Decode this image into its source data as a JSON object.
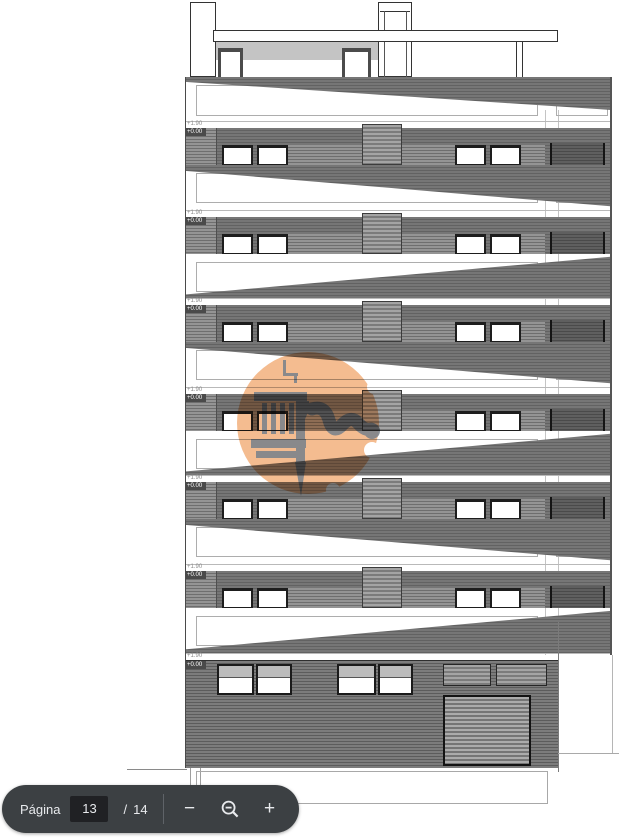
{
  "viewer": {
    "toolbar": {
      "page_label": "Página",
      "current_page": "13",
      "separator": "/",
      "total_pages": "14",
      "zoom_out_icon": "minus-icon",
      "zoom_reset_icon": "magnifier-minus-icon",
      "zoom_in_icon": "plus-icon",
      "background": "#3c4043",
      "input_background": "#202124",
      "text_color": "#e8eaed"
    }
  },
  "drawing": {
    "type": "architectural-building-elevation",
    "floors": [
      {
        "level_label": "+1.90",
        "base_label": "+0.00"
      },
      {
        "level_label": "+1.90",
        "base_label": "+0.00"
      },
      {
        "level_label": "+1.90",
        "base_label": "+0.00"
      },
      {
        "level_label": "+1.90",
        "base_label": "+0.00"
      },
      {
        "level_label": "+1.90",
        "base_label": "+0.00"
      },
      {
        "level_label": "+1.90",
        "base_label": "+0.00"
      },
      {
        "level_label": "+1.90",
        "base_label": "+0.00"
      }
    ],
    "colors": {
      "facade_dark": "#6e6e6e",
      "facade_light": "#919191",
      "parapet_gray": "#c4c4c4",
      "frame_black": "#1d1d1d",
      "guide_line": "#adadad"
    },
    "watermark": {
      "shape": "circle-logo",
      "icon": "caliper-logo-icon",
      "circle_color": "#f4bc90",
      "icon_color": "#7e848b"
    }
  }
}
